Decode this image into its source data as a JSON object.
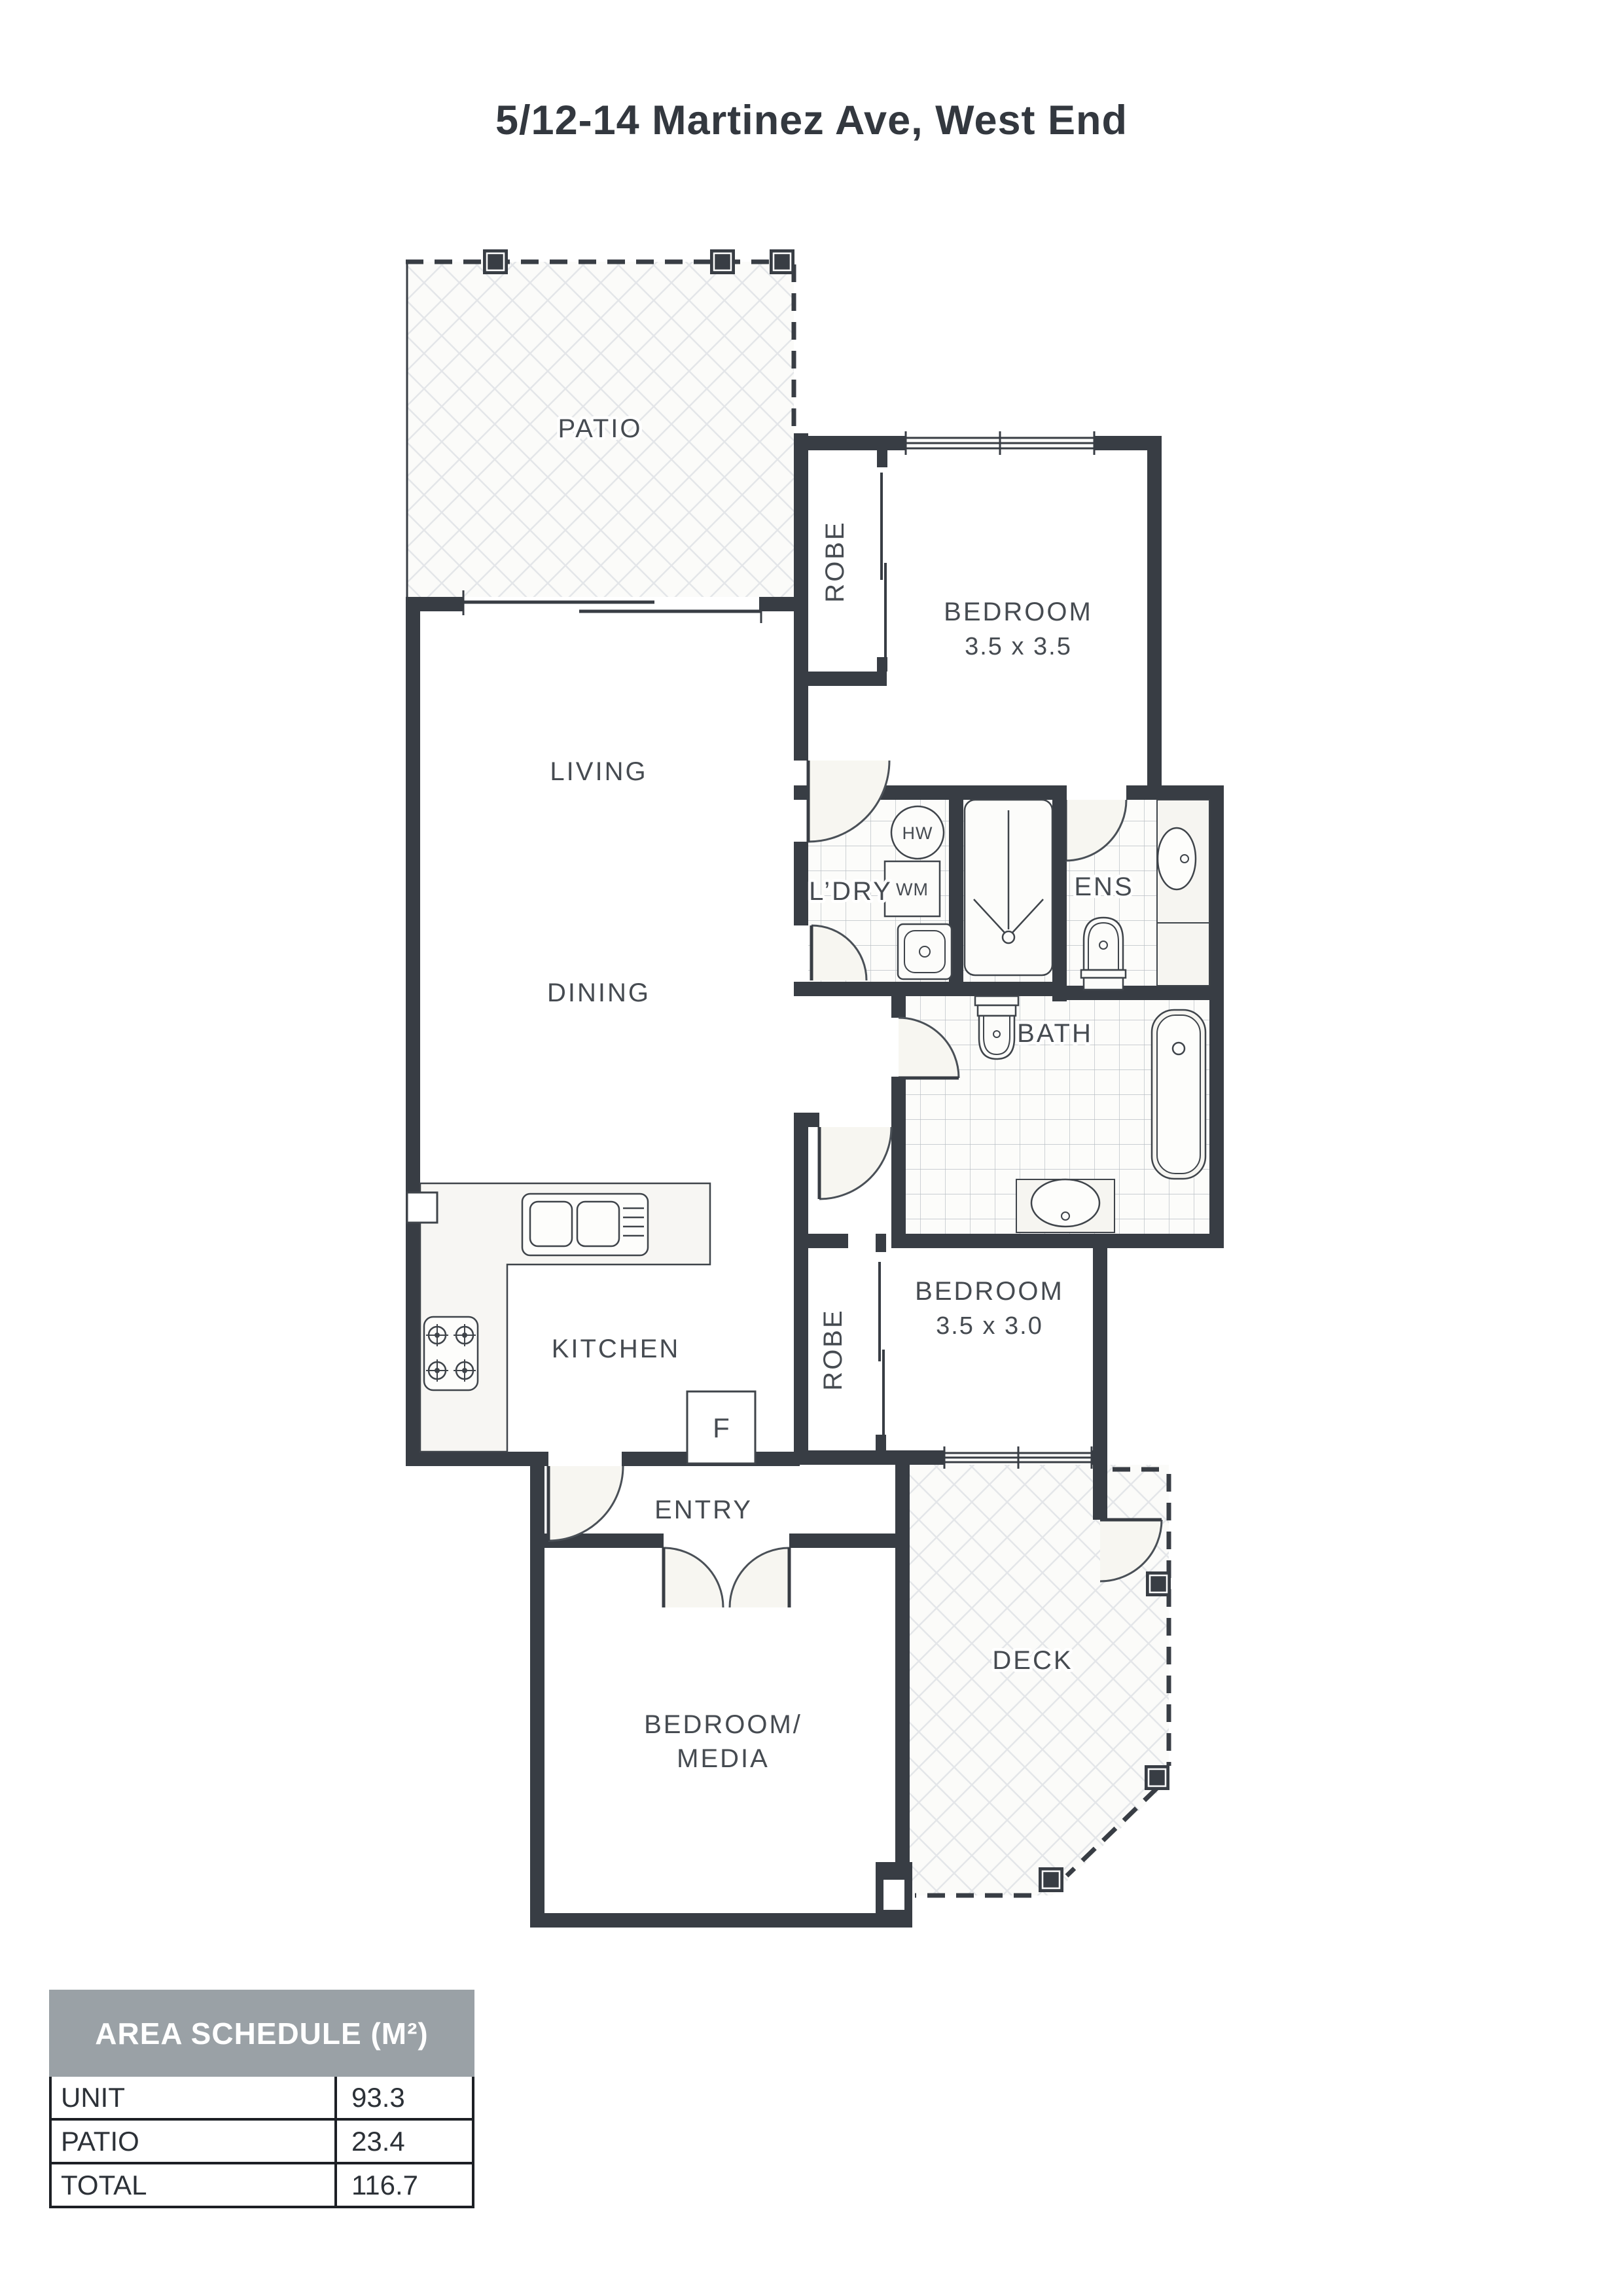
{
  "title": "5/12-14 Martinez Ave, West End",
  "rooms": {
    "patio": "PATIO",
    "living": "LIVING",
    "dining": "DINING",
    "kitchen": "KITCHEN",
    "entry": "ENTRY",
    "deck": "DECK",
    "bath": "BATH",
    "ensuite": "ENS",
    "laundry": "L’DRY",
    "bedroom1": {
      "label": "BEDROOM",
      "dims": "3.5 x 3.5"
    },
    "bedroom2": {
      "label": "BEDROOM",
      "dims": "3.5 x 3.0"
    },
    "bedroom_media": {
      "line1": "BEDROOM/",
      "line2": "MEDIA"
    },
    "robe1": "ROBE",
    "robe2": "ROBE"
  },
  "fixtures": {
    "hot_water": "HW",
    "washing_machine": "WM",
    "fridge": "F"
  },
  "area_schedule": {
    "title": "AREA SCHEDULE (M²)",
    "rows": [
      {
        "label": "UNIT",
        "value": "93.3"
      },
      {
        "label": "PATIO",
        "value": "23.4"
      },
      {
        "label": "TOTAL",
        "value": "116.7"
      }
    ]
  },
  "colors": {
    "wall": "#383d44",
    "header_bg": "#9aa1a6",
    "label": "#464b51",
    "tile_line": "#b9bfc4",
    "lattice_line": "#e4e6e9"
  }
}
